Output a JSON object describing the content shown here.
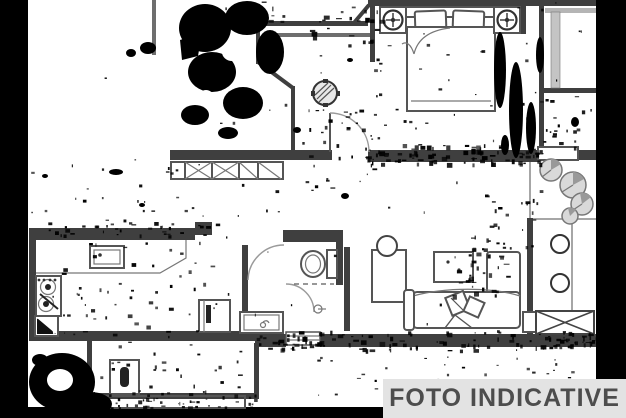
{
  "banner": {
    "label": "FOTO INDICATIVE",
    "bg": "#e3e3e3",
    "text_color": "#4d4d4d"
  },
  "plan": {
    "type": "apartment-floor-plan-scan",
    "style": "black and white architectural line drawing with heavy scan noise blotches and black border strips",
    "colors": {
      "background": "#ffffff",
      "walls": "#3f3f3f",
      "furniture": "#555555",
      "noise": "#000000",
      "plant_fill": "#d9d9d9",
      "shade": "#bfbfbf"
    },
    "rooms": [
      {
        "name": "entry-hall",
        "features": [
          "entry-door-arc",
          "ceiling-light",
          "wardrobe-x-panels"
        ]
      },
      {
        "name": "bedroom",
        "features": [
          "double-bed",
          "two-pillows",
          "headboard",
          "nightstand-left",
          "nightstand-right",
          "round-lamp-left",
          "round-lamp-right"
        ]
      },
      {
        "name": "closet-top-right",
        "features": [
          "shaded-shaft"
        ]
      },
      {
        "name": "kitchen",
        "features": [
          "counter",
          "kitchen-sink",
          "cooktop-two-burners",
          "corner-cabinet",
          "fridge-cabinet"
        ]
      },
      {
        "name": "bathroom",
        "features": [
          "toilet",
          "door-arc",
          "shower-arc",
          "dashed-shower-screen",
          "vanity-sink",
          "floor-drain"
        ]
      },
      {
        "name": "living-room",
        "features": [
          "l-shaped-sofa",
          "decor-pillows",
          "coffee-table",
          "dining-table",
          "chair-circle",
          "threshold-hatch",
          "side-step"
        ]
      },
      {
        "name": "balcony-right",
        "features": [
          "four-plants",
          "two-round-stools",
          "x-hatched-unit",
          "window-lintel"
        ]
      },
      {
        "name": "balcony-bottom-left",
        "features": [
          "washing-machine",
          "parapet-wall"
        ]
      }
    ],
    "scan_artifacts": [
      "left-black-strip",
      "right-black-strip",
      "bottom-black-bar",
      "large-ink-blob-top-center",
      "ink-streaks-right-of-bed",
      "ink-blob-bottom-left",
      "speckle-noise-along-walls"
    ]
  }
}
